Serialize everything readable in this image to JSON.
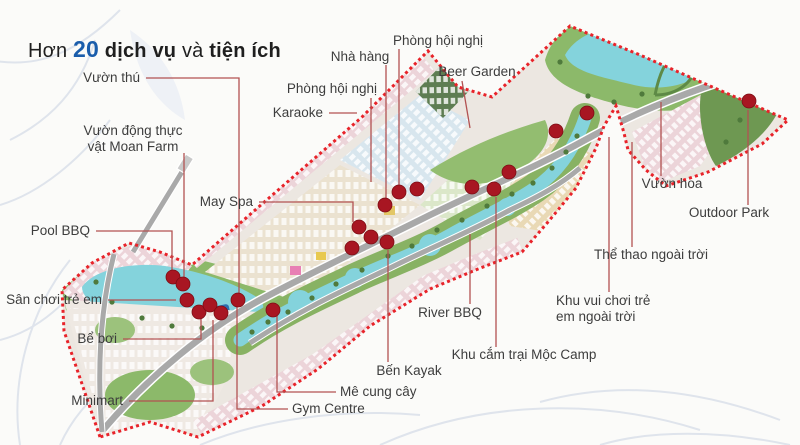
{
  "palette": {
    "background": "#fbfbf9",
    "boundary_red": "#e8232a",
    "dot_red": "#a81622",
    "leader_line": "#b25252",
    "label_text": "#3d3d3d",
    "title_dark": "#1f1f1f",
    "title_blue": "#1a5dab",
    "river": "#84d3dc",
    "park_green": "#8cb96a",
    "dark_green": "#5e7d52",
    "road_gray": "#a9a9a9",
    "housing_pink": "#ecd4d9",
    "housing_cream": "#e9d9b5",
    "housing_blue": "#d8e6ee",
    "leaf_art": "#dfe4ec"
  },
  "title": {
    "full_text": "Hơn 20 dịch vụ và tiện ích",
    "parts": [
      {
        "text": "Hơn ",
        "style": "regular"
      },
      {
        "text": "20",
        "style": "number"
      },
      {
        "text": " dịch vụ ",
        "style": "bold"
      },
      {
        "text": "và ",
        "style": "regular"
      },
      {
        "text": "tiện ích",
        "style": "bold"
      }
    ]
  },
  "amenities": [
    {
      "name": "vuon-thu",
      "lines": [
        "Vườn thú"
      ],
      "x": 140,
      "y": 78,
      "align": "right",
      "leader": [
        [
          146,
          78
        ],
        [
          239,
          78
        ],
        [
          239,
          293
        ]
      ]
    },
    {
      "name": "vuon-dong-thuc-vat-moan-farm",
      "lines": [
        "Vườn động thực",
        "vật Moan Farm"
      ],
      "x": 133,
      "y": 139,
      "align": "center",
      "leader": [
        [
          184,
          153
        ],
        [
          184,
          277
        ]
      ]
    },
    {
      "name": "pool-bbq",
      "lines": [
        "Pool BBQ"
      ],
      "x": 90,
      "y": 231,
      "align": "right",
      "leader": [
        [
          96,
          231
        ],
        [
          172,
          231
        ],
        [
          172,
          270
        ]
      ]
    },
    {
      "name": "san-choi-tre-em",
      "lines": [
        "Sân chơi trẻ em"
      ],
      "x": 102,
      "y": 300,
      "align": "right",
      "leader": [
        [
          108,
          300
        ],
        [
          176,
          300
        ]
      ]
    },
    {
      "name": "be-boi",
      "lines": [
        "Bể bơi"
      ],
      "x": 117,
      "y": 339,
      "align": "right",
      "leader": [
        [
          123,
          339
        ],
        [
          201,
          339
        ],
        [
          201,
          319
        ]
      ]
    },
    {
      "name": "minimart",
      "lines": [
        "Minimart"
      ],
      "x": 123,
      "y": 401,
      "align": "right",
      "leader": [
        [
          129,
          401
        ],
        [
          213,
          401
        ],
        [
          213,
          320
        ]
      ]
    },
    {
      "name": "may-spa",
      "lines": [
        "May Spa"
      ],
      "x": 253,
      "y": 202,
      "align": "right",
      "leader": [
        [
          259,
          202
        ],
        [
          353,
          202
        ],
        [
          353,
          222
        ]
      ]
    },
    {
      "name": "karaoke",
      "lines": [
        "Karaoke"
      ],
      "x": 323,
      "y": 113,
      "align": "right",
      "leader": [
        [
          329,
          113
        ],
        [
          357,
          113
        ]
      ]
    },
    {
      "name": "phong-hoi-nghi-left",
      "lines": [
        "Phòng hội nghị"
      ],
      "x": 377,
      "y": 89,
      "align": "right",
      "leader": [
        [
          371,
          98
        ],
        [
          371,
          182
        ]
      ]
    },
    {
      "name": "nha-hang",
      "lines": [
        "Nhà hàng"
      ],
      "x": 360,
      "y": 57,
      "align": "center",
      "leader": [
        [
          386,
          65
        ],
        [
          386,
          198
        ]
      ]
    },
    {
      "name": "phong-hoi-nghi-top",
      "lines": [
        "Phòng hội nghị"
      ],
      "x": 438,
      "y": 41,
      "align": "center",
      "leader": [
        [
          399,
          49
        ],
        [
          399,
          185
        ]
      ]
    },
    {
      "name": "beer-garden",
      "lines": [
        "Beer Garden"
      ],
      "x": 477,
      "y": 72,
      "align": "center",
      "leader": [
        [
          462,
          81
        ],
        [
          470,
          128
        ]
      ]
    },
    {
      "name": "vuon-hoa",
      "lines": [
        "Vườn hoa"
      ],
      "x": 672,
      "y": 184,
      "align": "center",
      "leader": [
        [
          661,
          176
        ],
        [
          661,
          102
        ]
      ]
    },
    {
      "name": "outdoor-park",
      "lines": [
        "Outdoor Park"
      ],
      "x": 729,
      "y": 213,
      "align": "center",
      "leader": [
        [
          748,
          205
        ],
        [
          748,
          110
        ]
      ]
    },
    {
      "name": "the-thao-ngoai-troi",
      "lines": [
        "Thể thao ngoài trời"
      ],
      "x": 651,
      "y": 255,
      "align": "center",
      "leader": [
        [
          632,
          247
        ],
        [
          632,
          142
        ]
      ]
    },
    {
      "name": "khu-vui-choi-tre-em-ngoai-troi",
      "lines": [
        "Khu vui chơi trẻ",
        "em ngoài trời"
      ],
      "x": 556,
      "y": 309,
      "align": "left",
      "leader": [
        [
          609,
          292
        ],
        [
          609,
          137
        ]
      ]
    },
    {
      "name": "khu-cam-trai-moc-camp",
      "lines": [
        "Khu cắm trại Mộc Camp"
      ],
      "x": 524,
      "y": 355,
      "align": "center",
      "leader": [
        [
          496,
          347
        ],
        [
          496,
          197
        ]
      ]
    },
    {
      "name": "river-bbq",
      "lines": [
        "River BBQ"
      ],
      "x": 450,
      "y": 313,
      "align": "center",
      "leader": [
        [
          470,
          304
        ],
        [
          470,
          234
        ]
      ]
    },
    {
      "name": "ben-kayak",
      "lines": [
        "Bến Kayak"
      ],
      "x": 409,
      "y": 371,
      "align": "center",
      "leader": [
        [
          388,
          362
        ],
        [
          388,
          250
        ]
      ]
    },
    {
      "name": "me-cung-cay",
      "lines": [
        "Mê cung cây"
      ],
      "x": 340,
      "y": 392,
      "align": "left",
      "leader": [
        [
          336,
          392
        ],
        [
          277,
          392
        ],
        [
          277,
          316
        ]
      ]
    },
    {
      "name": "gym-centre",
      "lines": [
        "Gym Centre"
      ],
      "x": 292,
      "y": 409,
      "align": "left",
      "leader": [
        [
          288,
          409
        ],
        [
          237,
          409
        ],
        [
          237,
          305
        ]
      ]
    }
  ],
  "dots": [
    [
      173,
      277
    ],
    [
      183,
      284
    ],
    [
      187,
      300
    ],
    [
      199,
      312
    ],
    [
      210,
      305
    ],
    [
      221,
      313
    ],
    [
      238,
      300
    ],
    [
      273,
      310
    ],
    [
      352,
      248
    ],
    [
      359,
      227
    ],
    [
      371,
      237
    ],
    [
      387,
      242
    ],
    [
      385,
      205
    ],
    [
      399,
      192
    ],
    [
      417,
      189
    ],
    [
      472,
      187
    ],
    [
      494,
      189
    ],
    [
      509,
      172
    ],
    [
      556,
      131
    ],
    [
      587,
      113
    ],
    [
      749,
      101
    ]
  ],
  "dot_radius": 7
}
